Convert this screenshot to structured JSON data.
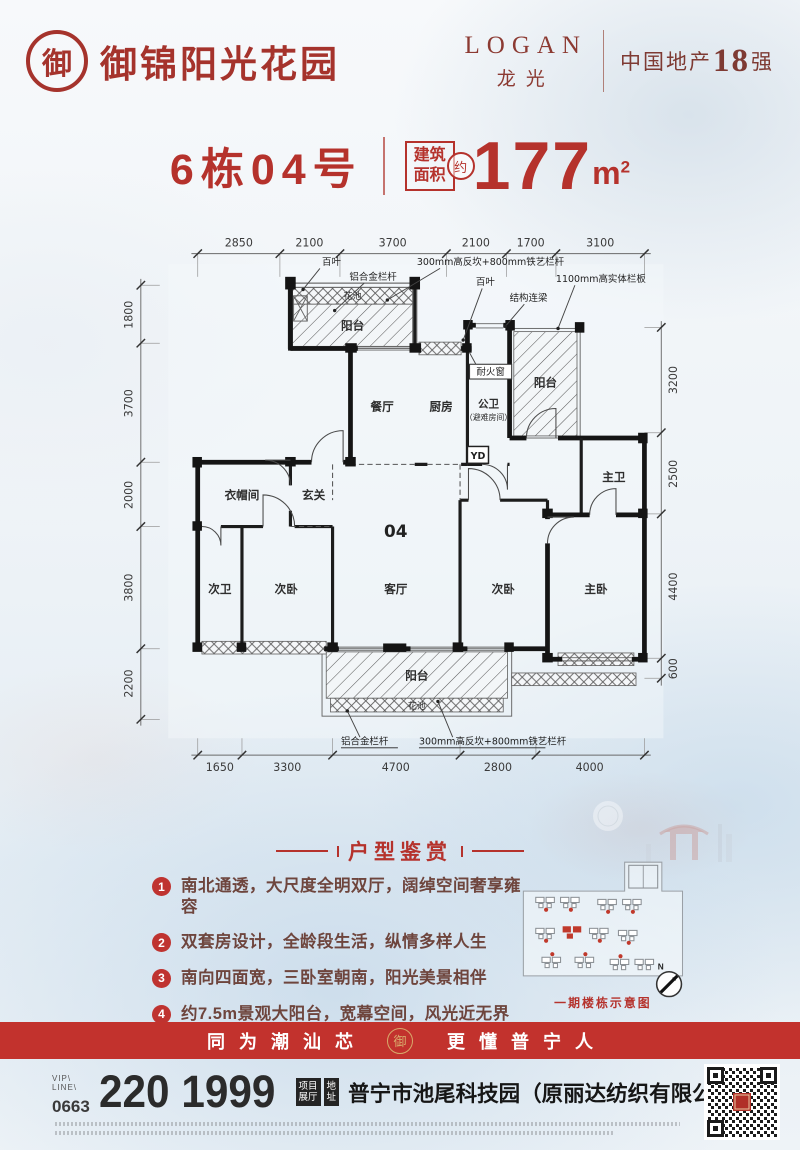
{
  "colors": {
    "brand_red": "#a5332c",
    "accent_red": "#b5322c",
    "banner_red": "#c2322d",
    "gold": "#d8a96b",
    "feature_text": "#6e453d",
    "cad_ink": "#151515"
  },
  "header": {
    "logo_glyph": "御",
    "project_name": "御锦阳光花园",
    "brand_en": "LOGAN",
    "brand_cn": "龙光",
    "rank_prefix": "中国地产",
    "rank_number": "18",
    "rank_suffix": "强"
  },
  "title": {
    "unit_name": "6栋04号",
    "area_tag_line1": "建筑",
    "area_tag_line2": "面积",
    "approx": "约",
    "area_value": "177",
    "area_unit_base": "m",
    "area_unit_sup": "2"
  },
  "plan": {
    "unit_number": "04",
    "rooms": {
      "dining": "餐厅",
      "kitchen": "厨房",
      "public_bath": "公卫",
      "public_bath_sub": "（避难房间）",
      "balcony_top": "阳台",
      "flowerbed_top": "花池",
      "balcony_right": "阳台",
      "master_bath": "主卫",
      "cloakroom": "衣帽间",
      "foyer": "玄关",
      "second_bath": "次卫",
      "bedroom_left": "次卧",
      "living": "客厅",
      "bedroom_right": "次卧",
      "master_bedroom": "主卧",
      "balcony_bottom": "阳台",
      "flowerbed_bottom": "花池"
    },
    "annotations": {
      "louver_top": "百叶",
      "alu_rail_top": "铝合金栏杆",
      "iron_rail_top": "300mm高反坎+800mm铁艺栏杆",
      "louver_right": "百叶",
      "structural_beam": "结构连梁",
      "solid_panel": "1100mm高实体栏板",
      "fire_window": "耐火窗",
      "duct": "YD",
      "alu_rail_bottom": "铝合金栏杆",
      "iron_rail_bottom": "300mm高反坎+800mm铁艺栏杆"
    },
    "dims_top": [
      "2850",
      "2100",
      "3700",
      "2100",
      "1700",
      "3100"
    ],
    "dims_bottom": [
      "1650",
      "3300",
      "4700",
      "2800",
      "4000"
    ],
    "dims_left": [
      "1800",
      "3700",
      "2000",
      "3800",
      "2200"
    ],
    "dims_right": [
      "3200",
      "2500",
      "4400",
      "600"
    ]
  },
  "features": {
    "heading": "户型鉴赏",
    "items": [
      {
        "num": "1",
        "text": "南北通透，大尺度全明双厅，阔绰空间奢享雍容"
      },
      {
        "num": "2",
        "text": "双套房设计，全龄段生活，纵情多样人生"
      },
      {
        "num": "3",
        "text": "南向四面宽，三卧室朝南，阳光美景相伴"
      },
      {
        "num": "4",
        "text": "约7.5m景观大阳台，宽幕空间，风光近无界"
      }
    ]
  },
  "site_map": {
    "caption": "一期楼栋示意图",
    "compass_label": "N"
  },
  "banner": {
    "left_text": "同为潮汕芯",
    "logo_glyph": "御",
    "right_text": "更懂普宁人"
  },
  "footer": {
    "vip_line1": "VIP\\",
    "vip_line2": "LINE\\",
    "vip_code": "0663",
    "phone": "220 1999",
    "tag_box1_line1": "项目",
    "tag_box1_line2": "展厅",
    "tag_box2_line1": "地",
    "tag_box2_line2": "址",
    "address": "普宁市池尾科技园（原丽达纺织有限公司）"
  }
}
